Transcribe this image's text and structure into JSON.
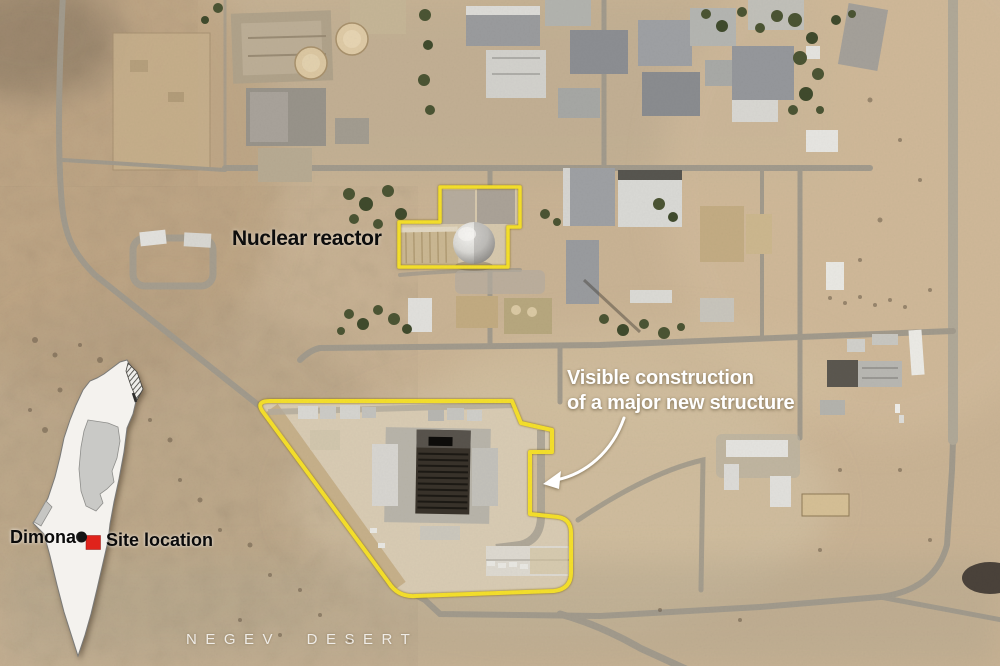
{
  "graphic": {
    "labels": {
      "reactor": "Nuclear reactor",
      "construction_line1": "Visible construction",
      "construction_line2": "of a major new structure",
      "region": "NEGEV DESERT"
    },
    "inset_map": {
      "city": "Dimona",
      "site": "Site location"
    },
    "colors": {
      "annotation_outline": "#f4df2b",
      "site_marker": "#e0231b",
      "city_dot": "#141414",
      "arrow": "#ffffff"
    }
  }
}
